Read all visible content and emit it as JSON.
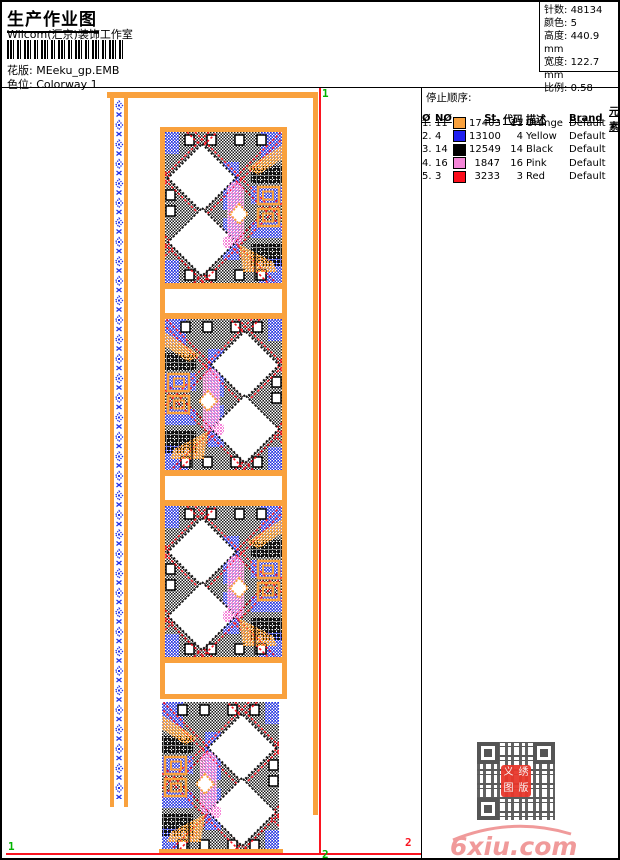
{
  "header": {
    "title": "生产作业图",
    "studio": "Wilcom(汇京)装饰工作室",
    "pattern_label": "花版:",
    "pattern_value": "MEeku_gp.EMB",
    "colorway_label": "色位:",
    "colorway_value": "Colorway 1"
  },
  "design_info": {
    "rows": [
      {
        "label": "针数:",
        "value": "48134"
      },
      {
        "label": "颜色:",
        "value": "5"
      },
      {
        "label": "高度:",
        "value": "440.9 mm"
      },
      {
        "label": "宽度:",
        "value": "122.7 mm"
      },
      {
        "label": "比例:",
        "value": "0.58"
      }
    ]
  },
  "stop_sequence": {
    "title": "停止顺序:",
    "columns": [
      "Ø",
      "NØ",
      "St.",
      "代码",
      "描述",
      "Brand",
      "元素"
    ],
    "rows": [
      {
        "seq": "1.",
        "needle": "11",
        "swatch": "#F9A13D",
        "stitches": "17403",
        "code": "11",
        "description": "Orange",
        "brand": "Default",
        "element": ""
      },
      {
        "seq": "2.",
        "needle": "4",
        "swatch": "#1F1FF0",
        "stitches": "13100",
        "code": "4",
        "description": "Yellow",
        "brand": "Default",
        "element": ""
      },
      {
        "seq": "3.",
        "needle": "14",
        "swatch": "#000000",
        "stitches": "12549",
        "code": "14",
        "description": "Black",
        "brand": "Default",
        "element": ""
      },
      {
        "seq": "4.",
        "needle": "16",
        "swatch": "#F585D8",
        "stitches": "1847",
        "code": "16",
        "description": "Pink",
        "brand": "Default",
        "element": ""
      },
      {
        "seq": "5.",
        "needle": "3",
        "swatch": "#FB0D1B",
        "stitches": "3233",
        "code": "3",
        "description": "Red",
        "brand": "Default",
        "element": ""
      }
    ]
  },
  "hoop_marks": {
    "top_right": "1",
    "bottom_left": "1",
    "bottom_center": "2",
    "bottom_right": "2"
  },
  "watermark": {
    "text": "6xiu.com",
    "seal": {
      "c1": "义",
      "c2": "绣",
      "c3": "图",
      "c4": "版"
    }
  },
  "palette": {
    "orange": "#F9A13D",
    "blue": "#2230E8",
    "black": "#111111",
    "pink": "#F585D8",
    "red": "#FA1420",
    "green": "#00B400"
  }
}
